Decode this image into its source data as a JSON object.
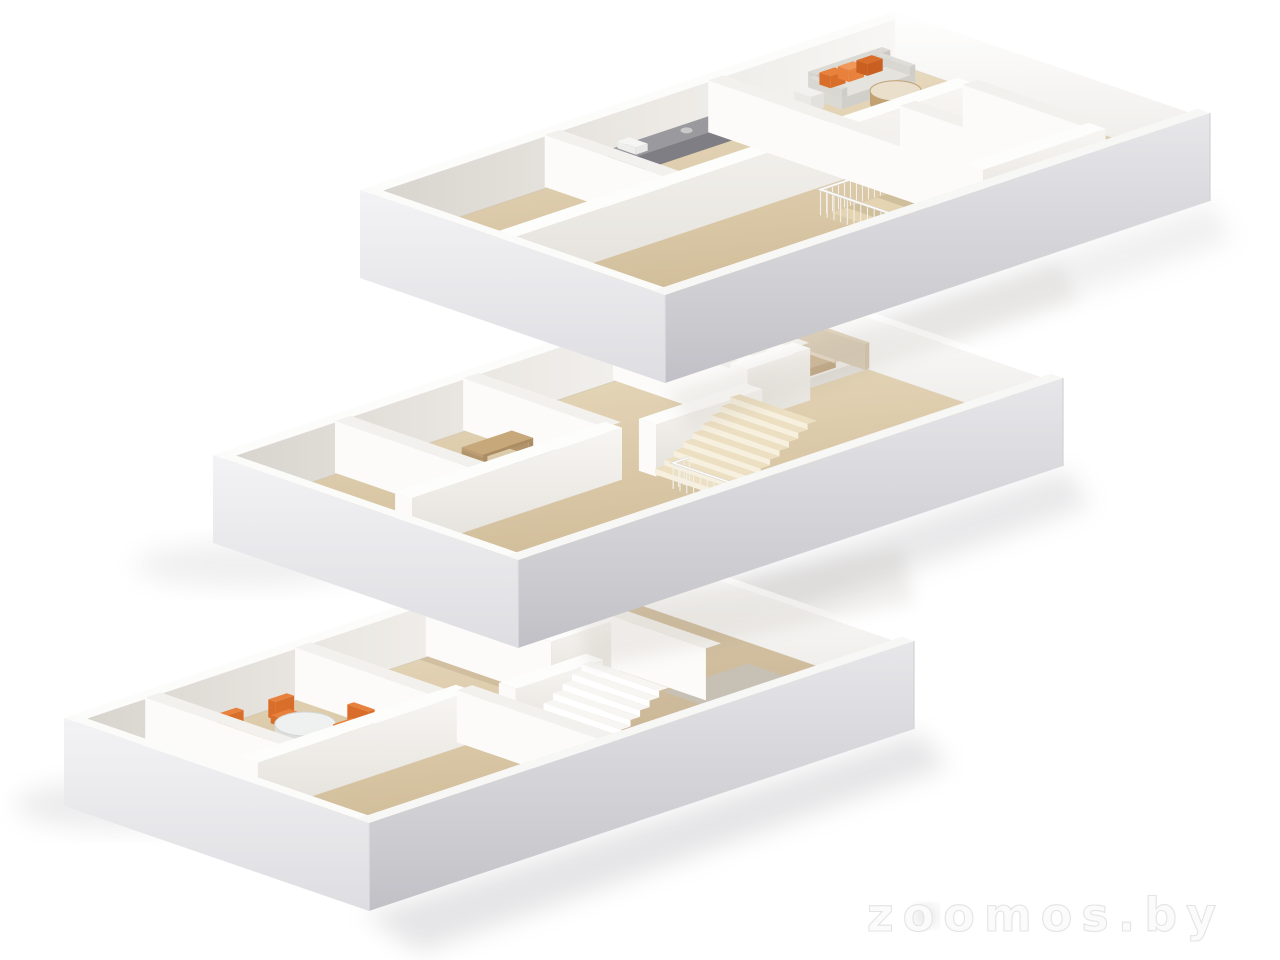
{
  "meta": {
    "type": "3d-isometric-floor-plan-render",
    "description": "Three stacked isometric 3D floor plans of a three-storey home on a white background",
    "floor_count": 3,
    "background_color": "#ffffff"
  },
  "watermark": {
    "text": "zoomos.by",
    "color": "#e4e4e4"
  },
  "palette": {
    "wall_bright": "#fcfbf9",
    "wall_front_light": "#f8f6f3",
    "wall_front_dark": "#e4e1db",
    "wall_shade": "#d7d3cd",
    "slab_light": "#f3f3f5",
    "slab_dark": "#c9c9ce",
    "floor_light": "#ecdfc4",
    "floor_dark": "#cdb893",
    "floor_dim": "#b49e7d",
    "accent_orange": "#e8813c",
    "accent_orange_dark": "#d96e2a",
    "accent_orange_light": "#f0975a",
    "sofa_gray": "#d8d6d1",
    "sage_green": "#b5bba9",
    "bed_tan": "#d2bc9b",
    "desk_wood": "#bb9c74",
    "counter_dark": "#8a898e",
    "rug_gray": "#c6c2ba",
    "stair_beige": "#ecdfc2",
    "stair_white": "#f7f6f3",
    "railing_white": "#f2efe9",
    "table_marble": "#eff1f0",
    "shadow": "#9a9aa0"
  },
  "floors": [
    {
      "id": "floor-1",
      "label": "Ground floor",
      "position": "lower-left",
      "rooms": [
        "entry",
        "dining-room",
        "hall",
        "bathroom",
        "living-room"
      ],
      "furniture": [
        "storage-box",
        "dining-table",
        "dining-chairs",
        "staircase-up",
        "sage-sofa",
        "rug"
      ]
    },
    {
      "id": "floor-2",
      "label": "Middle floor",
      "position": "center",
      "rooms": [
        "room-left",
        "study",
        "hall",
        "bathroom",
        "wc",
        "bedroom"
      ],
      "furniture": [
        "desk",
        "desk-chair",
        "staircase-up",
        "stairwell-opening",
        "stair-railing",
        "bed"
      ]
    },
    {
      "id": "floor-3",
      "label": "Top floor",
      "position": "upper-right",
      "rooms": [
        "bedroom",
        "kitchen",
        "living-room",
        "bathroom",
        "wc",
        "landing"
      ],
      "furniture": [
        "kitchen-counter",
        "sofa-with-orange-pillows",
        "side-table",
        "coffee-table",
        "stairwell-opening",
        "stair-railing"
      ]
    }
  ]
}
